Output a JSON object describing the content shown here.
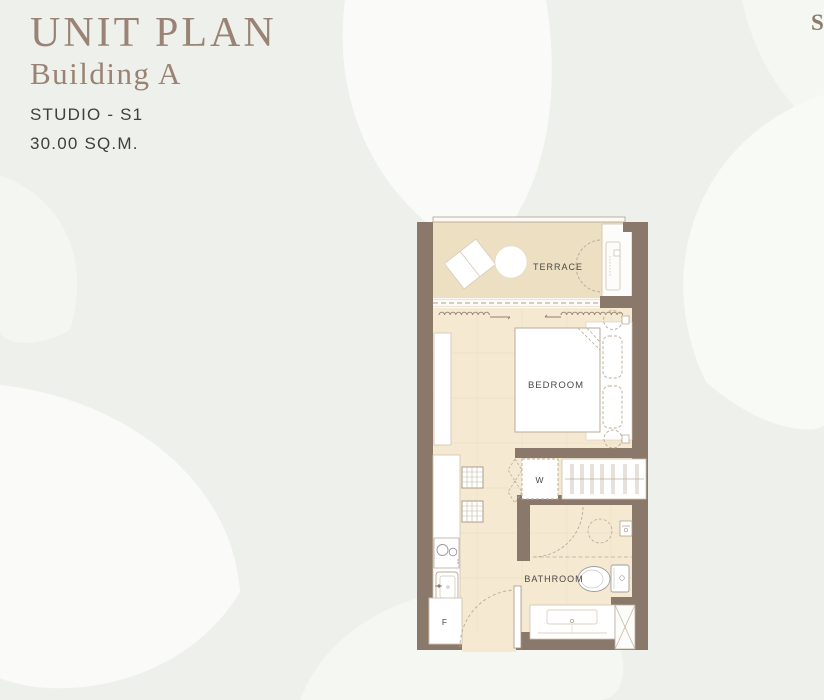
{
  "header": {
    "title": "UNIT PLAN",
    "subtitle": "Building A",
    "unit_type": "STUDIO - S1",
    "area": "30.00 SQ.M.",
    "corner_mark": "S"
  },
  "plan": {
    "rooms": {
      "terrace": "TERRACE",
      "bedroom": "BEDROOM",
      "bathroom": "BATHROOM"
    },
    "fixtures": {
      "washer": "W",
      "fridge": "F"
    }
  },
  "colors": {
    "background": "#eef0eb",
    "petal_white": "#fafbf8",
    "wall": "#8a796b",
    "interior_floor": "#f5e9d2",
    "terrace_floor": "#eddfc2",
    "title_text": "#9a8374",
    "dark_text": "#3f3f3c",
    "plan_line": "#b9ab99"
  }
}
